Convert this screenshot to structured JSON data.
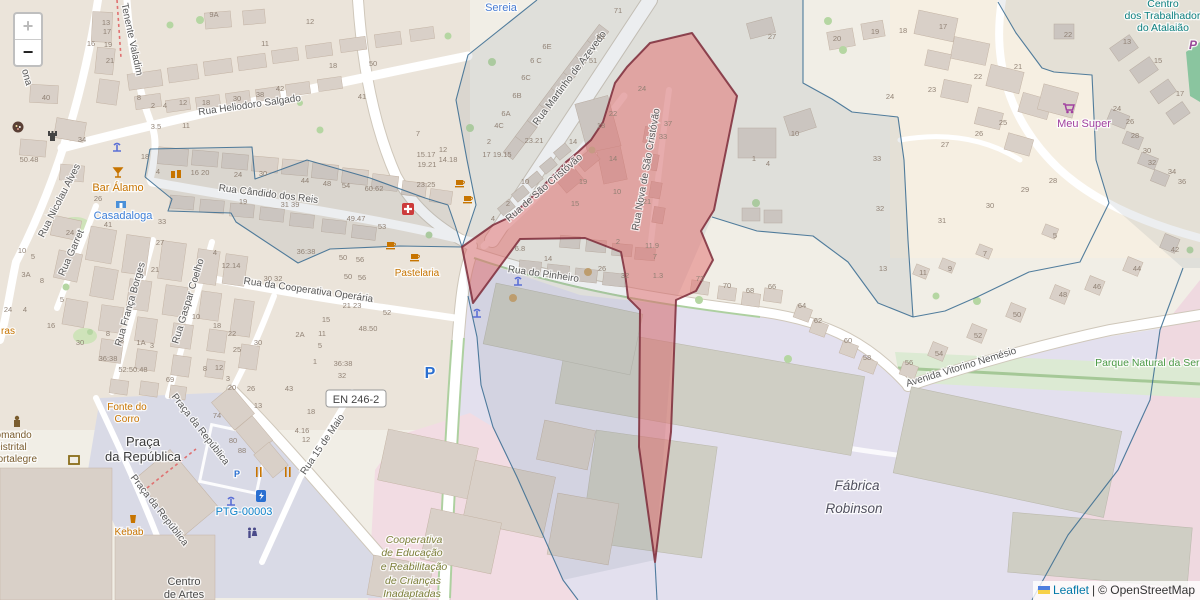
{
  "controls": {
    "zoom_in": "+",
    "zoom_out": "−"
  },
  "attribution": {
    "leaflet": "Leaflet",
    "separator": "|",
    "osm": "© OpenStreetMap"
  },
  "road_ref": {
    "text": "EN 246-2"
  },
  "colors": {
    "highlight_fill": "#e16a6a",
    "highlight_stroke": "#7d2b3a",
    "cell_stroke": "#35688f",
    "link_blue": "#0078a8"
  },
  "labels": {
    "streets": [
      {
        "text": "Rua Heliodoro Salgado",
        "x": 250,
        "y": 108,
        "rot": -8
      },
      {
        "text": "Tenente Valadim",
        "x": 129,
        "y": 40,
        "rot": 78
      },
      {
        "text": "Rua Cândido dos Reis",
        "x": 268,
        "y": 197,
        "rot": 7
      },
      {
        "text": "Rua Nicolau Alves",
        "x": 62,
        "y": 202,
        "rot": -63
      },
      {
        "text": "Rua Garret",
        "x": 74,
        "y": 254,
        "rot": -66
      },
      {
        "text": "Rua França Borges",
        "x": 133,
        "y": 305,
        "rot": -74
      },
      {
        "text": "Rua Gaspar Coelho",
        "x": 191,
        "y": 302,
        "rot": -73
      },
      {
        "text": "Rua da Cooperativa Operária",
        "x": 308,
        "y": 293,
        "rot": 8
      },
      {
        "text": "Rua Martinho de Azevedo",
        "x": 572,
        "y": 80,
        "rot": -53
      },
      {
        "text": "Rua de São Cristóvão",
        "x": 546,
        "y": 190,
        "rot": -41
      },
      {
        "text": "Rua Nova de São Cristóvão",
        "x": 649,
        "y": 170,
        "rot": -80
      },
      {
        "text": "Rua do Pinheiro",
        "x": 543,
        "y": 277,
        "rot": 8
      },
      {
        "text": "Avenida Vitorino Nemésio",
        "x": 962,
        "y": 370,
        "rot": -17
      },
      {
        "text": "Praça da República",
        "x": 198,
        "y": 431,
        "rot": 52
      },
      {
        "text": "Praça da República",
        "x": 157,
        "y": 512,
        "rot": 52
      },
      {
        "text": "Rua 15 de Maio",
        "x": 325,
        "y": 446,
        "rot": -56
      },
      {
        "text": "ona",
        "x": 24,
        "y": 78,
        "rot": 75
      }
    ],
    "places": [
      {
        "text": "Sereia",
        "x": 501,
        "y": 11,
        "color": "#4a7dd4",
        "size": 11
      },
      {
        "text": "Bar Álamo",
        "x": 118,
        "y": 191,
        "color": "#c77400",
        "size": 11
      },
      {
        "text": "Casadaloga",
        "x": 123,
        "y": 219,
        "color": "#3d7fd9",
        "size": 11
      },
      {
        "text": "Pastelaria",
        "x": 417,
        "y": 276,
        "color": "#c77400",
        "size": 10
      },
      {
        "text": "Meu Super",
        "x": 1084,
        "y": 127,
        "color": "#a140a0",
        "size": 11
      },
      {
        "text": "Fonte do",
        "x": 127,
        "y": 410,
        "color": "#c77400",
        "size": 10
      },
      {
        "text": "Corro",
        "x": 127,
        "y": 422,
        "color": "#c77400",
        "size": 10
      },
      {
        "text": "Comando",
        "x": 10,
        "y": 438,
        "color": "#7a5c2e",
        "size": 10
      },
      {
        "text": "Distrital",
        "x": 10,
        "y": 450,
        "color": "#7a5c2e",
        "size": 10
      },
      {
        "text": "Portalegre",
        "x": 14,
        "y": 462,
        "color": "#7a5c2e",
        "size": 10
      },
      {
        "text": "Praça",
        "x": 143,
        "y": 446,
        "color": "#3a3a3a",
        "size": 13
      },
      {
        "text": "da República",
        "x": 143,
        "y": 461,
        "color": "#3a3a3a",
        "size": 13
      },
      {
        "text": "Kebab",
        "x": 129,
        "y": 535,
        "color": "#c77400",
        "size": 10
      },
      {
        "text": "PTG-00003",
        "x": 244,
        "y": 515,
        "color": "#0f82c9",
        "size": 11
      },
      {
        "text": "Centro",
        "x": 184,
        "y": 585,
        "color": "#4a4a4a",
        "size": 11
      },
      {
        "text": "de Artes",
        "x": 184,
        "y": 598,
        "color": "#4a4a4a",
        "size": 11
      },
      {
        "text": "Cooperativa",
        "x": 414,
        "y": 543,
        "color": "#7c7f3a",
        "size": 10.5,
        "italic": true
      },
      {
        "text": "de Educação",
        "x": 412,
        "y": 556,
        "color": "#7c7f3a",
        "size": 10.5,
        "italic": true
      },
      {
        "text": "e Reabilitação",
        "x": 414,
        "y": 570,
        "color": "#7c7f3a",
        "size": 10.5,
        "italic": true
      },
      {
        "text": "de Crianças",
        "x": 413,
        "y": 584,
        "color": "#7c7f3a",
        "size": 10.5,
        "italic": true
      },
      {
        "text": "Inadaptadas",
        "x": 412,
        "y": 597,
        "color": "#7c7f3a",
        "size": 10.5,
        "italic": true
      },
      {
        "text": "Fábrica",
        "x": 857,
        "y": 490,
        "color": "#50505e",
        "size": 13.5,
        "italic": true
      },
      {
        "text": "Robinson",
        "x": 854,
        "y": 513,
        "color": "#50505e",
        "size": 13.5,
        "italic": true
      },
      {
        "text": "Centro",
        "x": 1163,
        "y": 7,
        "color": "#0d8080",
        "size": 10.5
      },
      {
        "text": "dos Trabalhadores",
        "x": 1168,
        "y": 19,
        "color": "#0d8080",
        "size": 10.5
      },
      {
        "text": "do Atalaião",
        "x": 1163,
        "y": 31,
        "color": "#0d8080",
        "size": 10.5
      },
      {
        "text": "Parque Natural da Serra",
        "x": 1152,
        "y": 366,
        "color": "#4c9a46",
        "size": 10.5
      },
      {
        "text": "ras",
        "x": 8,
        "y": 334,
        "color": "#c77400",
        "size": 10
      },
      {
        "text": "P",
        "x": 430,
        "y": 378,
        "color": "#2a6fd1",
        "size": 16,
        "bold": true
      },
      {
        "text": "P",
        "x": 237,
        "y": 477,
        "color": "#2a6fd1",
        "size": 9,
        "bold": true
      },
      {
        "text": "P",
        "x": 1193,
        "y": 49,
        "color": "#9a4a9a",
        "size": 12,
        "bold": true,
        "italic": true
      }
    ],
    "housenumbers": [
      [
        214,
        17,
        "9A"
      ],
      [
        106,
        25,
        "13"
      ],
      [
        107,
        34,
        "17"
      ],
      [
        91,
        46,
        "16"
      ],
      [
        108,
        47,
        "19"
      ],
      [
        110,
        63,
        "21"
      ],
      [
        265,
        46,
        "11"
      ],
      [
        46,
        100,
        "40"
      ],
      [
        139,
        100,
        "8"
      ],
      [
        153,
        108,
        "2"
      ],
      [
        165,
        108,
        "4"
      ],
      [
        183,
        105,
        "12"
      ],
      [
        206,
        105,
        "18"
      ],
      [
        237,
        101,
        "30"
      ],
      [
        260,
        97,
        "38"
      ],
      [
        280,
        91,
        "42"
      ],
      [
        156,
        129,
        "3.5"
      ],
      [
        186,
        128,
        "11"
      ],
      [
        82,
        142,
        "34"
      ],
      [
        29,
        162,
        "50.48"
      ],
      [
        145,
        159,
        "18"
      ],
      [
        158,
        174,
        "4"
      ],
      [
        200,
        175,
        "16 20"
      ],
      [
        238,
        177,
        "24"
      ],
      [
        263,
        176,
        "30"
      ],
      [
        98,
        201,
        "26"
      ],
      [
        310,
        24,
        "12"
      ],
      [
        333,
        68,
        "18"
      ],
      [
        373,
        66,
        "50"
      ],
      [
        362,
        99,
        "41"
      ],
      [
        418,
        136,
        "7"
      ],
      [
        443,
        152,
        "12"
      ],
      [
        426,
        157,
        "15.17"
      ],
      [
        427,
        167,
        "19.21"
      ],
      [
        448,
        162,
        "14.18"
      ],
      [
        426,
        187,
        "23.25"
      ],
      [
        305,
        183,
        "44"
      ],
      [
        327,
        186,
        "48"
      ],
      [
        346,
        188,
        "54"
      ],
      [
        374,
        191,
        "60.62"
      ],
      [
        356,
        221,
        "49.47"
      ],
      [
        382,
        229,
        "53"
      ],
      [
        547,
        49,
        "6E"
      ],
      [
        536,
        63,
        "6 C"
      ],
      [
        526,
        80,
        "6C"
      ],
      [
        517,
        98,
        "6B"
      ],
      [
        506,
        116,
        "6A"
      ],
      [
        499,
        128,
        "4C"
      ],
      [
        489,
        144,
        "2"
      ],
      [
        534,
        143,
        "23.21"
      ],
      [
        497,
        157,
        "17 19.15"
      ],
      [
        573,
        144,
        "14"
      ],
      [
        618,
        13,
        "71"
      ],
      [
        601,
        39,
        "61"
      ],
      [
        593,
        63,
        "51"
      ],
      [
        613,
        116,
        "22"
      ],
      [
        601,
        128,
        "18"
      ],
      [
        642,
        91,
        "24"
      ],
      [
        668,
        126,
        "37"
      ],
      [
        663,
        139,
        "33"
      ],
      [
        613,
        161,
        "14"
      ],
      [
        583,
        184,
        "19"
      ],
      [
        617,
        194,
        "10"
      ],
      [
        575,
        206,
        "15"
      ],
      [
        647,
        204,
        "21"
      ],
      [
        618,
        244,
        "2"
      ],
      [
        652,
        248,
        "11.9"
      ],
      [
        655,
        259,
        "7"
      ],
      [
        658,
        278,
        "1.3"
      ],
      [
        520,
        251,
        "6.8"
      ],
      [
        548,
        261,
        "14"
      ],
      [
        602,
        271,
        "26"
      ],
      [
        625,
        278,
        "32"
      ],
      [
        493,
        221,
        "4"
      ],
      [
        508,
        206,
        "2"
      ],
      [
        525,
        184,
        "10"
      ],
      [
        772,
        39,
        "27"
      ],
      [
        795,
        136,
        "10"
      ],
      [
        754,
        161,
        "1"
      ],
      [
        768,
        166,
        "4"
      ],
      [
        837,
        41,
        "20"
      ],
      [
        875,
        34,
        "19"
      ],
      [
        890,
        99,
        "24"
      ],
      [
        877,
        161,
        "33"
      ],
      [
        883,
        271,
        "13"
      ],
      [
        880,
        211,
        "32"
      ],
      [
        700,
        281,
        "72"
      ],
      [
        727,
        288,
        "70"
      ],
      [
        750,
        293,
        "68"
      ],
      [
        772,
        289,
        "66"
      ],
      [
        802,
        308,
        "64"
      ],
      [
        818,
        323,
        "62"
      ],
      [
        848,
        343,
        "60"
      ],
      [
        867,
        360,
        "58"
      ],
      [
        909,
        365,
        "56"
      ],
      [
        990,
        208,
        "30"
      ],
      [
        942,
        223,
        "31"
      ],
      [
        1055,
        238,
        "5"
      ],
      [
        985,
        256,
        "7"
      ],
      [
        950,
        271,
        "9"
      ],
      [
        923,
        275,
        "11"
      ],
      [
        1175,
        252,
        "42"
      ],
      [
        1137,
        271,
        "44"
      ],
      [
        1097,
        289,
        "46"
      ],
      [
        1063,
        297,
        "48"
      ],
      [
        1017,
        317,
        "50"
      ],
      [
        978,
        338,
        "52"
      ],
      [
        939,
        356,
        "54"
      ],
      [
        903,
        33,
        "18"
      ],
      [
        943,
        29,
        "17"
      ],
      [
        978,
        79,
        "22"
      ],
      [
        932,
        92,
        "23"
      ],
      [
        1018,
        69,
        "21"
      ],
      [
        1003,
        125,
        "25"
      ],
      [
        979,
        136,
        "26"
      ],
      [
        945,
        147,
        "27"
      ],
      [
        1053,
        183,
        "28"
      ],
      [
        1025,
        192,
        "29"
      ],
      [
        1068,
        37,
        "22"
      ],
      [
        1127,
        44,
        "13"
      ],
      [
        1158,
        63,
        "15"
      ],
      [
        1180,
        96,
        "17"
      ],
      [
        1117,
        111,
        "24"
      ],
      [
        1130,
        124,
        "26"
      ],
      [
        1135,
        138,
        "28"
      ],
      [
        1147,
        153,
        "30"
      ],
      [
        1152,
        165,
        "32"
      ],
      [
        1172,
        174,
        "34"
      ],
      [
        1182,
        184,
        "36"
      ],
      [
        306,
        254,
        "36:38"
      ],
      [
        343,
        260,
        "50"
      ],
      [
        360,
        262,
        "56"
      ],
      [
        352,
        308,
        "21 23"
      ],
      [
        387,
        315,
        "52"
      ],
      [
        326,
        322,
        "15"
      ],
      [
        368,
        331,
        "48.50"
      ],
      [
        300,
        337,
        "2A"
      ],
      [
        322,
        336,
        "11"
      ],
      [
        320,
        348,
        "5"
      ],
      [
        315,
        364,
        "1"
      ],
      [
        343,
        366,
        "36:38"
      ],
      [
        342,
        378,
        "32"
      ],
      [
        311,
        414,
        "18"
      ],
      [
        302,
        433,
        "4.16"
      ],
      [
        306,
        442,
        "12"
      ],
      [
        348,
        279,
        "50"
      ],
      [
        362,
        280,
        "56"
      ],
      [
        70,
        235,
        "24"
      ],
      [
        108,
        227,
        "41"
      ],
      [
        162,
        224,
        "33"
      ],
      [
        160,
        245,
        "27"
      ],
      [
        155,
        272,
        "21"
      ],
      [
        22,
        253,
        "10"
      ],
      [
        33,
        259,
        "5"
      ],
      [
        26,
        277,
        "3A"
      ],
      [
        42,
        283,
        "8"
      ],
      [
        62,
        302,
        "5"
      ],
      [
        8,
        312,
        "24"
      ],
      [
        25,
        312,
        "4"
      ],
      [
        51,
        328,
        "16"
      ],
      [
        108,
        336,
        "8"
      ],
      [
        80,
        345,
        "30"
      ],
      [
        122,
        343,
        "3"
      ],
      [
        141,
        345,
        "1A"
      ],
      [
        152,
        348,
        "3"
      ],
      [
        108,
        361,
        "36:38"
      ],
      [
        133,
        372,
        "52:50.48"
      ],
      [
        170,
        382,
        "69"
      ],
      [
        196,
        319,
        "10"
      ],
      [
        217,
        328,
        "18"
      ],
      [
        232,
        336,
        "22"
      ],
      [
        237,
        352,
        "25"
      ],
      [
        258,
        345,
        "30"
      ],
      [
        231,
        268,
        "12.14"
      ],
      [
        273,
        281,
        "30 32"
      ],
      [
        215,
        255,
        "4"
      ],
      [
        205,
        371,
        "8"
      ],
      [
        219,
        370,
        "12"
      ],
      [
        228,
        381,
        "3"
      ],
      [
        232,
        390,
        "20"
      ],
      [
        251,
        391,
        "26"
      ],
      [
        289,
        391,
        "43"
      ],
      [
        243,
        204,
        "19"
      ],
      [
        290,
        207,
        "31 39"
      ],
      [
        217,
        418,
        "74"
      ],
      [
        258,
        408,
        "13"
      ],
      [
        233,
        443,
        "80"
      ],
      [
        242,
        453,
        "88"
      ]
    ]
  },
  "icons": [
    "games-icon",
    "castle-icon",
    "fountain-icon",
    "cocktail-icon",
    "clothes-shop-icon",
    "shopfront-icon",
    "cafe-icon",
    "first-aid-icon",
    "shopping-cart-icon",
    "police-icon",
    "artwork-icon",
    "restaurant-icon",
    "charging-station-icon",
    "wc-icon",
    "fast-food-icon",
    "ua-flag-icon",
    "parking-icon"
  ]
}
